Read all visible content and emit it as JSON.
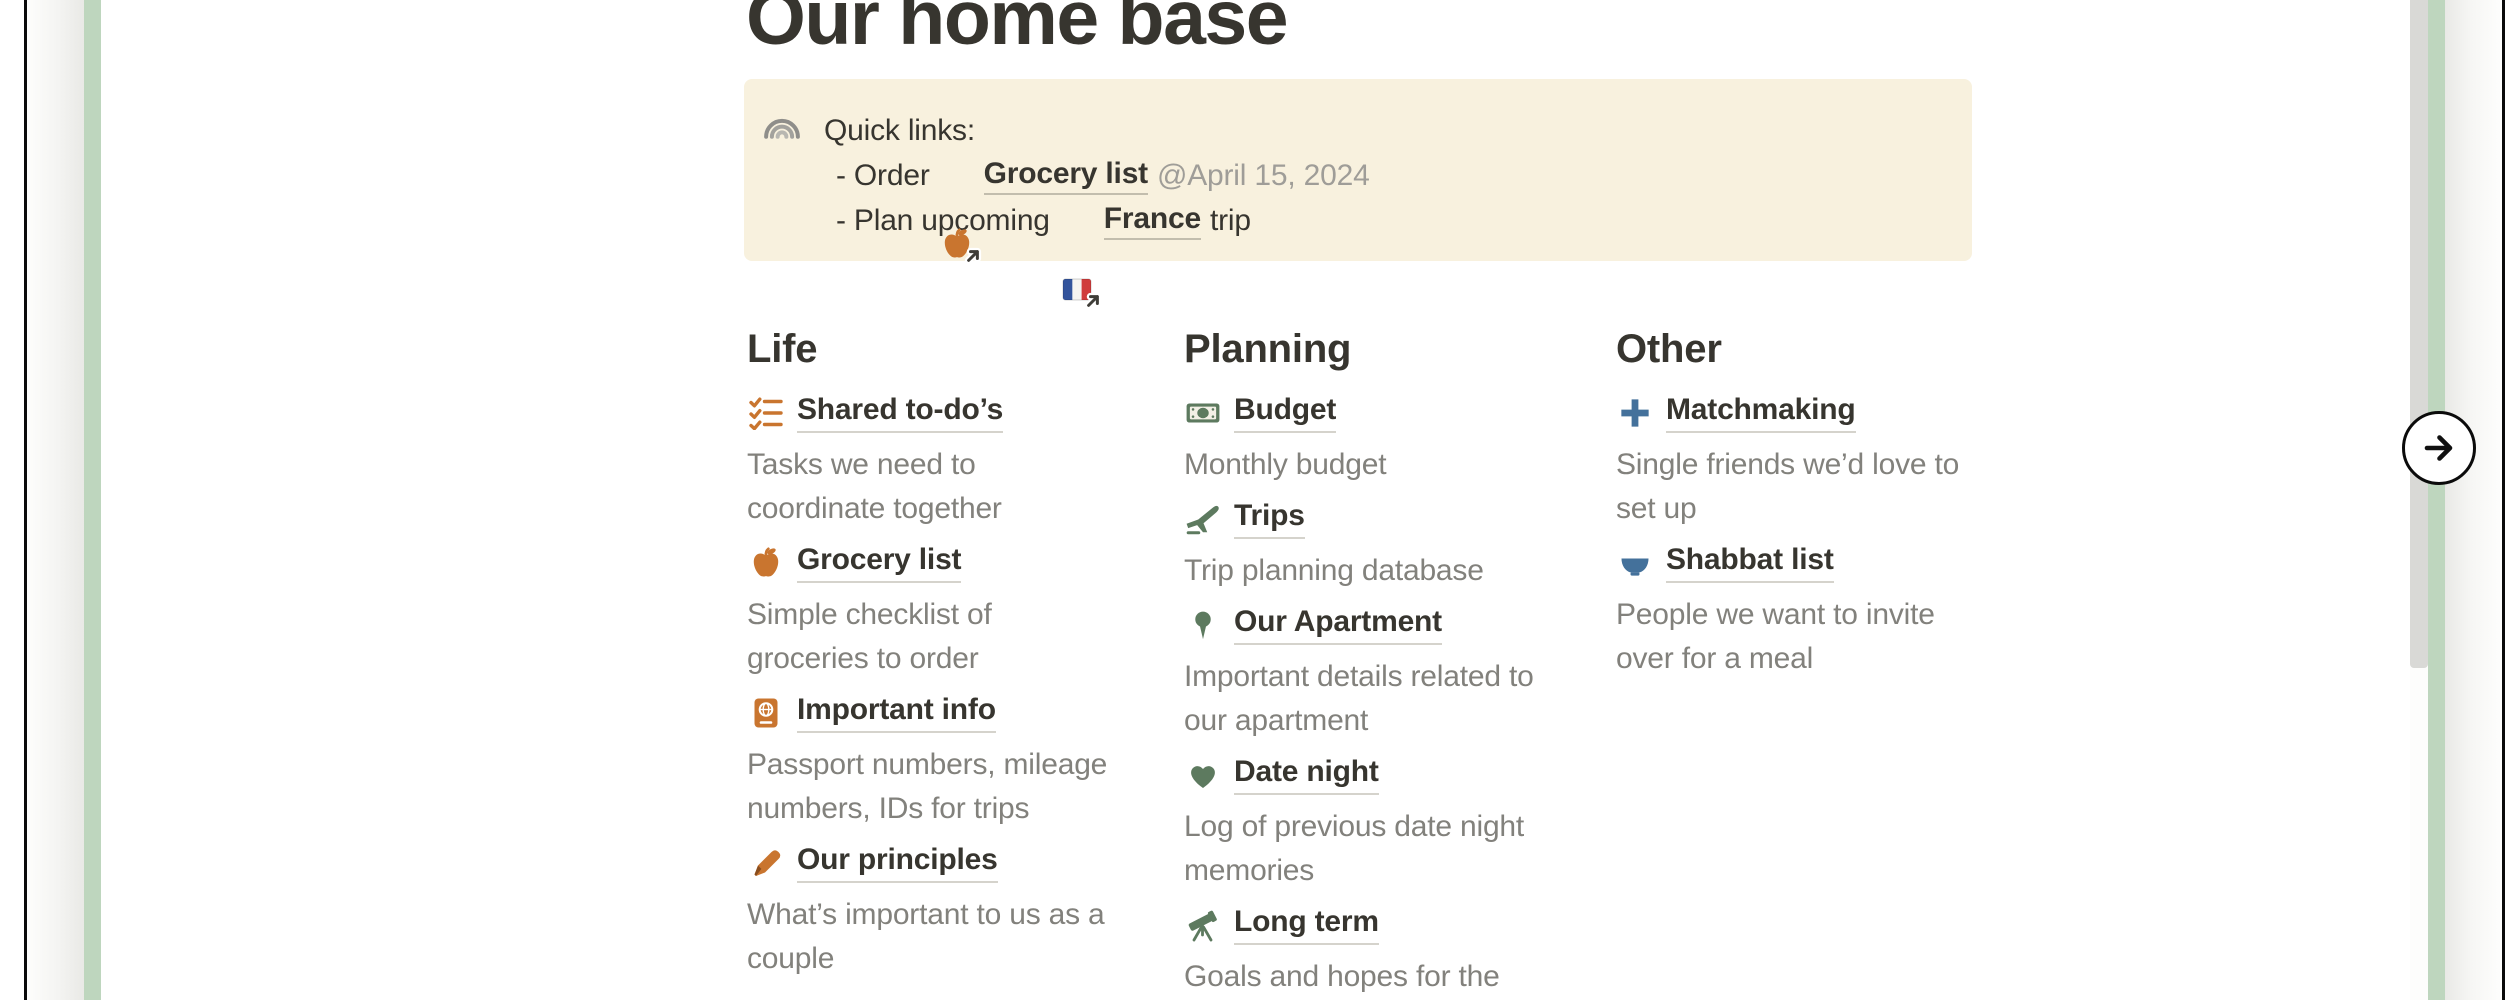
{
  "colors": {
    "text": "#37352f",
    "muted_text": "#82817c",
    "mention_gray": "#9f9d98",
    "callout_bg": "#f8f1de",
    "card_green": "#bed6be",
    "accent_orange": "#c9752f",
    "accent_green": "#5d7a5f",
    "accent_blue": "#44719b"
  },
  "page": {
    "title": "Our home base"
  },
  "callout": {
    "title_line": "Quick links:",
    "order_prefix": "- Order",
    "order_link": "Grocery list",
    "order_mention": "@April 15, 2024",
    "plan_prefix": "- Plan upcoming",
    "plan_link": "France",
    "plan_suffix": "trip"
  },
  "columns": [
    {
      "heading": "Life",
      "items": [
        {
          "icon": "todo-list-icon",
          "label": "Shared to-do’s",
          "desc": "Tasks we need to\ncoordinate together"
        },
        {
          "icon": "apple-icon",
          "label": "Grocery list",
          "desc": "Simple checklist of\ngroceries to order"
        },
        {
          "icon": "passport-icon",
          "label": "Important info",
          "desc": "Passport numbers, mileage\nnumbers, IDs for trips"
        },
        {
          "icon": "pen-icon",
          "label": "Our principles",
          "desc": "What’s important to us as a\ncouple"
        }
      ]
    },
    {
      "heading": "Planning",
      "items": [
        {
          "icon": "banknote-icon",
          "label": "Budget",
          "desc": "Monthly budget"
        },
        {
          "icon": "airplane-icon",
          "label": "Trips",
          "desc": "Trip planning database"
        },
        {
          "icon": "round-pushpin-icon",
          "label": "Our Apartment",
          "desc": "Important details related to\nour apartment"
        },
        {
          "icon": "heart-icon",
          "label": "Date night",
          "desc": "Log of previous date night\nmemories"
        },
        {
          "icon": "telescope-icon",
          "label": "Long term",
          "desc": "Goals and hopes for the"
        }
      ]
    },
    {
      "heading": "Other",
      "items": [
        {
          "icon": "plus-icon",
          "label": "Matchmaking",
          "desc": "Single friends we’d love to\nset up"
        },
        {
          "icon": "bowl-icon",
          "label": "Shabbat list",
          "desc": "People we want to invite\nover for a meal"
        }
      ]
    }
  ],
  "carousel": {
    "next_button_label": "Next"
  }
}
